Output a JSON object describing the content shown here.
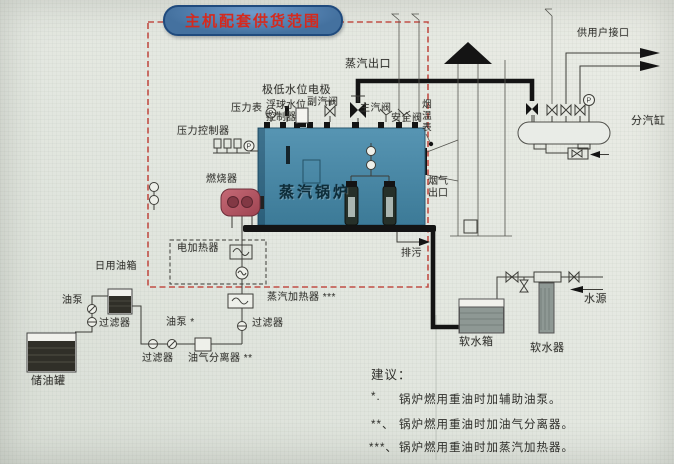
{
  "title": "主机配套供货范围",
  "colors": {
    "background": "#e3e7e0",
    "boiler_top": "#5795b3",
    "boiler_bottom": "#3c7a97",
    "burner": "#b2505d",
    "boundary_red": "#c14f46",
    "title_fill": "#44719f",
    "title_border": "#1f4a7d",
    "title_text": "#d42a1e",
    "ink": "#33332f",
    "pipe_black": "#141414",
    "oil_liquid": "#302f28",
    "equipment_gray": "#8e9894"
  },
  "labels": {
    "steam_outlet": "蒸汽出口",
    "user_supply": "供用户接口",
    "steam_cylinder": "分汽缸",
    "low_water_electrode": "极低水位电极",
    "pressure_gauge": "压力表",
    "float_controller": "浮球水位控制器",
    "aux_steam_valve": "副汽阀",
    "main_steam_valve": "主汽阀",
    "safety_valve": "安全阀",
    "flue_temp_gauge": "烟温表",
    "pressure_controller": "压力控制器",
    "burner": "燃烧器",
    "boiler": "蒸汽锅炉",
    "flue_outlet": "烟气出口",
    "electric_heater": "电加热器",
    "blowdown": "排污",
    "steam_heater": "蒸汽加热器 ***",
    "daily_oil_tank": "日用油箱",
    "oil_pump": "油泵",
    "filter": "过滤器",
    "oil_pump_aux": "油泵 *",
    "oil_gas_separator": "油气分离器 **",
    "storage_tank": "储油罐",
    "soft_water_tank": "软水箱",
    "water_softener": "软水器",
    "water_source": "水源",
    "gauge_p": "P"
  },
  "suggestions": {
    "heading": "建议：",
    "items": [
      {
        "marker": "*.",
        "text": "锅炉燃用重油时加辅助油泵。"
      },
      {
        "marker": "**、",
        "text": "锅炉燃用重油时加油气分离器。"
      },
      {
        "marker": "***、",
        "text": "锅炉燃用重油时加蒸汽加热器。"
      }
    ]
  }
}
